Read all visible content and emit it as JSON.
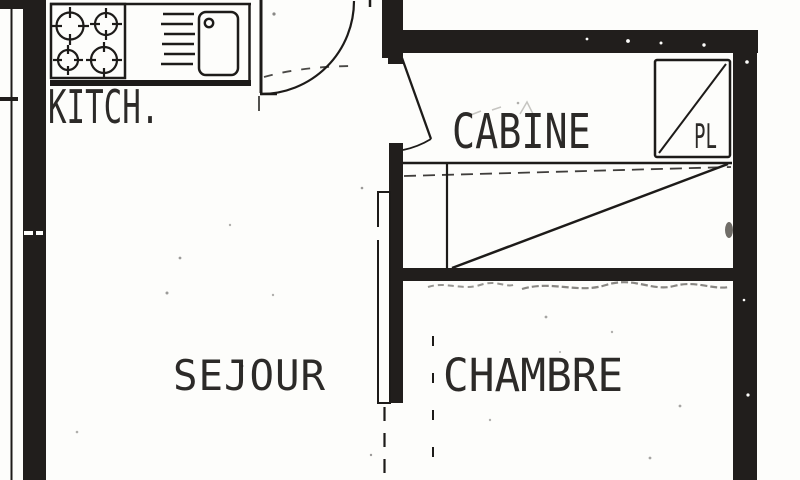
{
  "document": {
    "type": "scanned apartment floor plan",
    "language": "French"
  },
  "colors": {
    "paper": "#fdfdfb",
    "ink": "#1d1b19",
    "wall_fill": "#211e1c",
    "smudge": "#6b6965"
  },
  "rooms": {
    "kitchen": {
      "label": "KITCH."
    },
    "cabin": {
      "label": "CABINE"
    },
    "living": {
      "label": "SEJOUR"
    },
    "bedroom": {
      "label": "CHAMBRE"
    },
    "closet": {
      "label": "PL"
    }
  },
  "fixtures": {
    "stove": "four-burner hob",
    "sink": "single basin with drainer",
    "entrance_door": "90-degree swing",
    "cabin_door": "swing into cabin",
    "closet_symbol": "square with diagonal"
  }
}
